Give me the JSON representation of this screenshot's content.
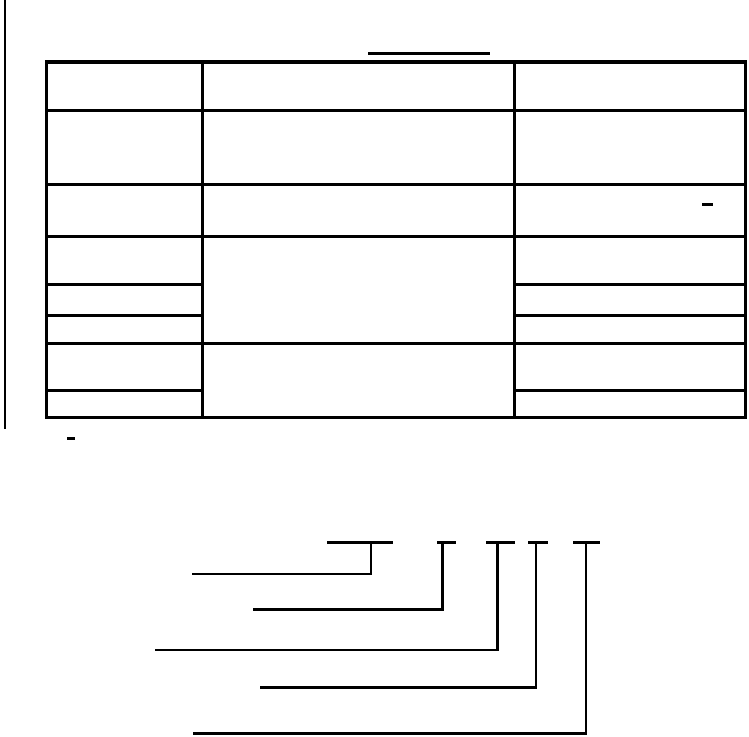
{
  "meta": {
    "background": "#ffffff",
    "line_color": "#000000",
    "canvas": {
      "width": 749,
      "height": 737
    }
  },
  "regions": {
    "page_border": {
      "segments": [
        {
          "name": "page-left-margin-rule",
          "x": 4,
          "y": 0,
          "w": 2,
          "h": 429
        }
      ]
    },
    "title": {
      "segments": [
        {
          "name": "table-title-underline",
          "x": 368,
          "y": 52,
          "w": 122,
          "h": 2.5
        }
      ]
    },
    "table": {
      "segments": [
        {
          "name": "table-outer-border-top",
          "x": 45,
          "y": 60,
          "w": 702,
          "h": 4
        },
        {
          "name": "table-outer-border-bottom",
          "x": 45,
          "y": 416,
          "w": 702,
          "h": 3
        },
        {
          "name": "table-outer-border-left",
          "x": 45,
          "y": 60,
          "w": 3,
          "h": 359
        },
        {
          "name": "table-outer-border-right",
          "x": 744,
          "y": 60,
          "w": 3,
          "h": 359
        },
        {
          "name": "table-column-divider-1",
          "x": 201,
          "y": 60,
          "w": 3,
          "h": 359
        },
        {
          "name": "table-column-divider-2",
          "x": 513,
          "y": 60,
          "w": 3,
          "h": 359
        },
        {
          "name": "table-row-divider-full-1",
          "x": 45,
          "y": 108.5,
          "w": 702,
          "h": 3
        },
        {
          "name": "table-row-divider-full-2",
          "x": 45,
          "y": 182.5,
          "w": 702,
          "h": 3
        },
        {
          "name": "table-row-divider-full-3",
          "x": 45,
          "y": 235,
          "w": 702,
          "h": 3
        },
        {
          "name": "table-row-divider-full-4",
          "x": 45,
          "y": 341.5,
          "w": 702,
          "h": 3
        },
        {
          "name": "table-row-divider-left-a",
          "x": 45,
          "y": 282.5,
          "w": 159,
          "h": 3
        },
        {
          "name": "table-row-divider-right-a",
          "x": 513,
          "y": 282.5,
          "w": 234,
          "h": 3
        },
        {
          "name": "table-row-divider-left-b",
          "x": 45,
          "y": 314,
          "w": 159,
          "h": 3
        },
        {
          "name": "table-row-divider-right-b",
          "x": 513,
          "y": 314,
          "w": 234,
          "h": 3
        },
        {
          "name": "table-row-divider-left-c",
          "x": 45,
          "y": 388.5,
          "w": 159,
          "h": 3
        },
        {
          "name": "table-row-divider-right-c",
          "x": 513,
          "y": 388.5,
          "w": 234,
          "h": 3
        }
      ]
    },
    "dashes": {
      "segments": [
        {
          "name": "table-cell-dash-row3-right",
          "x": 702,
          "y": 203,
          "w": 11,
          "h": 2.5
        },
        {
          "name": "footnote-dash-below-table",
          "x": 67,
          "y": 437,
          "w": 8,
          "h": 2.5
        }
      ]
    },
    "callouts": {
      "segments": [
        {
          "name": "callout1-overline",
          "x": 327,
          "y": 541,
          "w": 66,
          "h": 2.5
        },
        {
          "name": "callout1-drop-line",
          "x": 369.5,
          "y": 541,
          "w": 2.5,
          "h": 34
        },
        {
          "name": "callout1-leader-line",
          "x": 192,
          "y": 572.5,
          "w": 180,
          "h": 2.5
        },
        {
          "name": "callout2-overline",
          "x": 437,
          "y": 541,
          "w": 19,
          "h": 2.5
        },
        {
          "name": "callout2-drop-line",
          "x": 441,
          "y": 541,
          "w": 2.5,
          "h": 69.5
        },
        {
          "name": "callout2-leader-line",
          "x": 253,
          "y": 608,
          "w": 190.5,
          "h": 2.5
        },
        {
          "name": "callout3-overline",
          "x": 486,
          "y": 541,
          "w": 29,
          "h": 2.5
        },
        {
          "name": "callout3-drop-line",
          "x": 496,
          "y": 541,
          "w": 2.5,
          "h": 110
        },
        {
          "name": "callout3-leader-line",
          "x": 155,
          "y": 648.5,
          "w": 343.5,
          "h": 2.5
        },
        {
          "name": "callout4-overline",
          "x": 528,
          "y": 541,
          "w": 20,
          "h": 2.5
        },
        {
          "name": "callout4-drop-line",
          "x": 534.5,
          "y": 541,
          "w": 2.5,
          "h": 147.5
        },
        {
          "name": "callout4-leader-line",
          "x": 260,
          "y": 686,
          "w": 277,
          "h": 2.5
        },
        {
          "name": "callout5-overline",
          "x": 573,
          "y": 541,
          "w": 27,
          "h": 2.5
        },
        {
          "name": "callout5-drop-line",
          "x": 584.5,
          "y": 541,
          "w": 2.5,
          "h": 193.5
        },
        {
          "name": "callout5-leader-line",
          "x": 193,
          "y": 731.5,
          "w": 394,
          "h": 3
        }
      ]
    }
  }
}
